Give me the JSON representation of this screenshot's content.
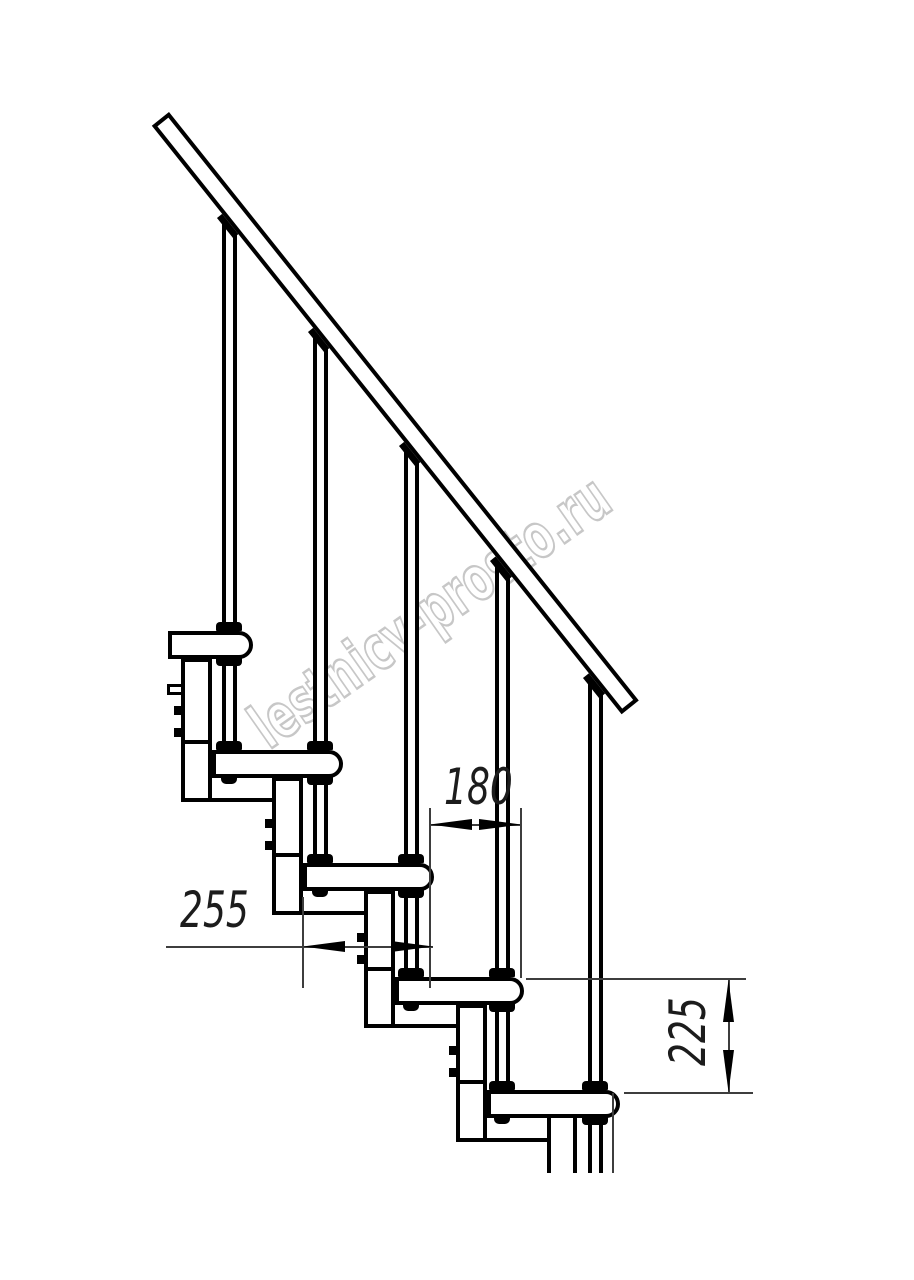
{
  "title": "Modular staircase side elevation drawing",
  "watermark": {
    "text": "lestnicy-prosto.ru",
    "color": "#c7c7c7"
  },
  "dims": {
    "d180": {
      "value": "180",
      "orientation": "horizontal",
      "references": "step run between tread noses"
    },
    "d255": {
      "value": "255",
      "orientation": "horizontal",
      "references": "tread depth"
    },
    "d225": {
      "value": "225",
      "orientation": "vertical",
      "references": "riser height between treads"
    }
  },
  "colors": {
    "line": "#000000",
    "thin_line": "#3d3d3d",
    "watermark": "#c7c7c7",
    "background": "#ffffff"
  },
  "structure": {
    "tread_count": 5,
    "baluster_count": 5,
    "support_pipe_count": 5,
    "handrail_angle_deg": 51.4
  }
}
